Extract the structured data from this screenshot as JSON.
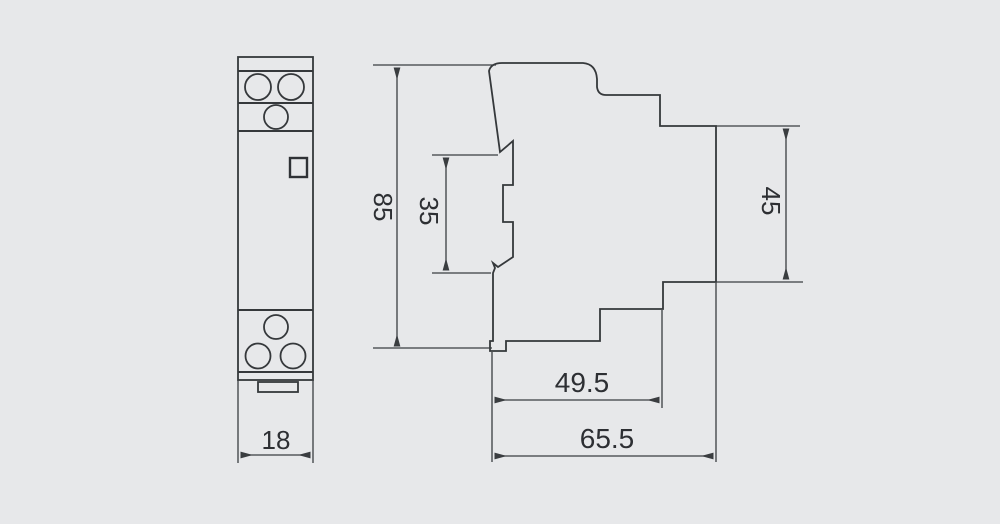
{
  "colors": {
    "background": "#e7e8ea",
    "line": "#35383b",
    "text": "#2d2f33"
  },
  "drawing": {
    "type": "dimension-diagram",
    "front_view": {
      "width": "18"
    },
    "side_view": {
      "overall_height": "85",
      "rail_slot_height": "35",
      "upper_depth": "45",
      "lower_depth": "49.5",
      "overall_depth": "65.5"
    }
  }
}
